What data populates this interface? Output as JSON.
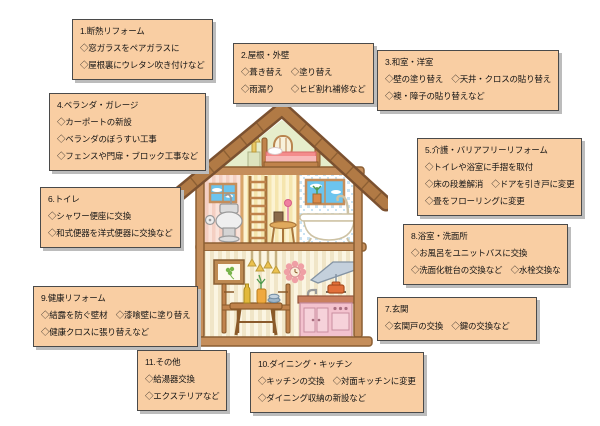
{
  "palette": {
    "background": "#FFFFFF",
    "box_bg": "#F9CEA3",
    "box_border": "#4A4A4A",
    "box_shadow": "#BCBCBC",
    "roof_brown": "#B17A45",
    "roof_outline": "#7B5130",
    "gable_green": "#E6EDCB",
    "beam_brown": "#C58E5B",
    "kitchen_pink": "#F3C2CE",
    "sky_blue": "#6CC4EE"
  },
  "boxes": [
    {
      "id": 1,
      "title": "1.断熱リフォーム",
      "items": [
        "◇窓ガラスをペアガラスに",
        "◇屋根裏にウレタン吹き付けなど"
      ]
    },
    {
      "id": 2,
      "title": "2.屋根・外壁",
      "items": [
        "◇葺き替え　◇塗り替え",
        "◇雨漏り　　◇ヒビ割れ補修など"
      ]
    },
    {
      "id": 3,
      "title": "3.和室・洋室",
      "items": [
        "◇壁の塗り替え　◇天井・クロスの貼り替え",
        "◇襖・障子の貼り替えなど"
      ]
    },
    {
      "id": 4,
      "title": "4.ベランダ・ガレージ",
      "items": [
        "◇カーポートの新設",
        "◇ベランダのぼうすい工事",
        "◇フェンスや門扉・ブロック工事など"
      ]
    },
    {
      "id": 5,
      "title": "5.介護・バリアフリーリフォーム",
      "items": [
        "◇トイレや浴室に手摺を取付",
        "◇床の段差解消　◇ドアを引き戸に変更",
        "◇畳をフローリングに変更"
      ]
    },
    {
      "id": 6,
      "title": "6.トイレ",
      "items": [
        "◇シャワー便座に交換",
        "◇和式便器を洋式便器に交換など"
      ]
    },
    {
      "id": 7,
      "title": "7.玄関",
      "items": [
        "◇玄関戸の交換　◇鍵の交換など"
      ]
    },
    {
      "id": 8,
      "title": "8.浴室・洗面所",
      "items": [
        "◇お風呂をユニットバスに交換",
        "◇洗面化粧台の交換など　◇水栓交換な"
      ]
    },
    {
      "id": 9,
      "title": "9.健康リフォーム",
      "items": [
        "◇結露を防ぐ壁材　◇漆喰壁に塗り替え",
        "◇健康クロスに張り替えなど"
      ]
    },
    {
      "id": 10,
      "title": "10.ダイニング・キッチン",
      "items": [
        "◇キッチンの交換　◇対面キッチンに変更",
        "◇ダイニング収納の新設など"
      ]
    },
    {
      "id": 11,
      "title": "11.その他",
      "items": [
        "◇給湯器交換",
        "◇エクステリアなど"
      ]
    }
  ]
}
